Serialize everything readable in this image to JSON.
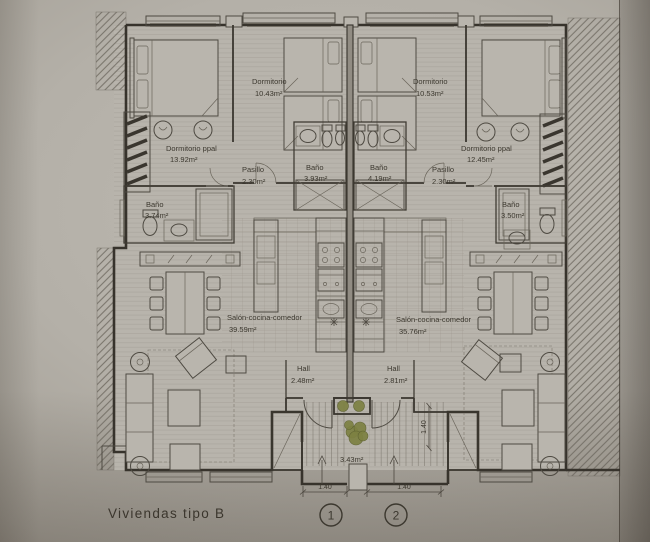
{
  "title": "Viviendas tipo B",
  "units": {
    "left": {
      "dormitorio_ppal": {
        "name": "Dormitorio ppal",
        "area": "13.92m²"
      },
      "dormitorio": {
        "name": "Dormitorio",
        "area": "10.43m²"
      },
      "bano_exterior": {
        "name": "Baño",
        "area": "3.74m²"
      },
      "bano_interior": {
        "name": "Baño",
        "area": "3.93m²"
      },
      "pasillo": {
        "name": "Pasillo",
        "area": "2.30m²"
      },
      "salon": {
        "name": "Salón-cocina-comedor",
        "area": "39.59m²"
      },
      "hall": {
        "name": "Hall",
        "area": "2.48m²"
      }
    },
    "right": {
      "dormitorio": {
        "name": "Dormitorio",
        "area": "10.53m²"
      },
      "dormitorio_ppal": {
        "name": "Dormitorio ppal",
        "area": "12.45m²"
      },
      "bano_interior": {
        "name": "Baño",
        "area": "4.19m²"
      },
      "bano_exterior": {
        "name": "Baño",
        "area": "3.50m²"
      },
      "pasillo": {
        "name": "Pasillo",
        "area": "2.30m²"
      },
      "salon": {
        "name": "Salón-cocina-comedor",
        "area": "35.76m²"
      },
      "hall": {
        "name": "Hall",
        "area": "2.81m²"
      }
    }
  },
  "entrance": {
    "area": "3.43m²",
    "dim_left": "1.40",
    "dim_right": "1.40",
    "dim_vertical": "1.40",
    "marker_1": "1",
    "marker_2": "2"
  },
  "colors": {
    "paper": "#b4b0a8",
    "ink": "#3a362f",
    "plants": "#7d8142"
  }
}
